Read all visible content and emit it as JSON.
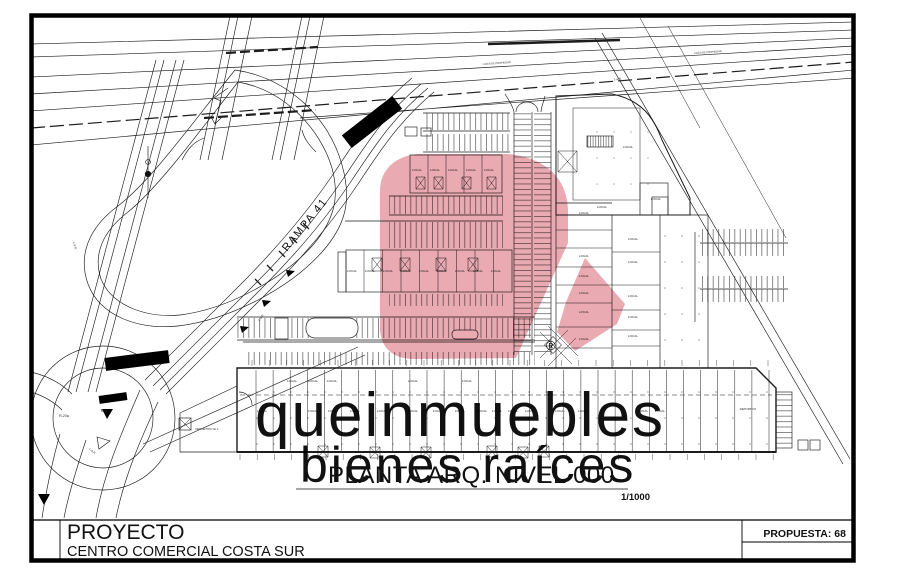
{
  "title_block": {
    "project_label": "PROYECTO",
    "project_name": "CENTRO COMERCIAL COSTA SUR",
    "proposal": "PROPUESTA: 68"
  },
  "plan": {
    "title": "PLANTA ARQ. NIVEL 000",
    "scale": "1/1000",
    "ramp_label": "RAMPA 41",
    "unit_label_default": "LOCAL",
    "unit_labels": [
      {
        "x": 417,
        "y": 171
      },
      {
        "x": 435,
        "y": 171
      },
      {
        "x": 453,
        "y": 171
      },
      {
        "x": 471,
        "y": 171
      },
      {
        "x": 489,
        "y": 171
      },
      {
        "x": 352,
        "y": 272
      },
      {
        "x": 370,
        "y": 272
      },
      {
        "x": 388,
        "y": 272
      },
      {
        "x": 406,
        "y": 272
      },
      {
        "x": 424,
        "y": 272
      },
      {
        "x": 442,
        "y": 272
      },
      {
        "x": 460,
        "y": 272
      },
      {
        "x": 478,
        "y": 272
      },
      {
        "x": 496,
        "y": 272
      },
      {
        "x": 584,
        "y": 214
      },
      {
        "x": 584,
        "y": 257
      },
      {
        "x": 584,
        "y": 277
      },
      {
        "x": 584,
        "y": 294
      },
      {
        "x": 584,
        "y": 313
      },
      {
        "x": 584,
        "y": 340
      },
      {
        "x": 633,
        "y": 240
      },
      {
        "x": 633,
        "y": 263
      },
      {
        "x": 633,
        "y": 297
      },
      {
        "x": 633,
        "y": 318
      },
      {
        "x": 633,
        "y": 337
      },
      {
        "x": 628,
        "y": 148
      },
      {
        "x": 602,
        "y": 208
      },
      {
        "x": 656,
        "y": 200
      },
      {
        "x": 292,
        "y": 382
      },
      {
        "x": 313,
        "y": 382
      },
      {
        "x": 332,
        "y": 382
      },
      {
        "x": 413,
        "y": 382
      },
      {
        "x": 467,
        "y": 382
      },
      {
        "x": 262,
        "y": 412
      },
      {
        "x": 313,
        "y": 412
      },
      {
        "x": 333,
        "y": 412
      },
      {
        "x": 355,
        "y": 412
      },
      {
        "x": 382,
        "y": 412
      },
      {
        "x": 413,
        "y": 412
      },
      {
        "x": 438,
        "y": 412
      },
      {
        "x": 460,
        "y": 412
      },
      {
        "x": 482,
        "y": 412
      },
      {
        "x": 497,
        "y": 412
      },
      {
        "x": 513,
        "y": 412
      },
      {
        "x": 530,
        "y": 412
      },
      {
        "x": 560,
        "y": 412
      },
      {
        "x": 583,
        "y": 412
      },
      {
        "x": 643,
        "y": 412
      },
      {
        "x": 660,
        "y": 412
      },
      {
        "x": 207,
        "y": 430,
        "t": "DEPORTIVO No.1",
        "s": 2.8
      },
      {
        "x": 748,
        "y": 410,
        "t": "DEPORTIVO",
        "s": 2.8
      }
    ],
    "road_labels": [
      {
        "t": "LINEA DE PROPIEDAD",
        "x": 497,
        "y": 64,
        "r": -4,
        "s": 2.6
      },
      {
        "t": "LINEA DE PROPIEDAD",
        "x": 708,
        "y": 53,
        "r": -4,
        "s": 2.6
      },
      {
        "t": "L.a.R.",
        "x": 618,
        "y": 80,
        "r": -4,
        "s": 3
      },
      {
        "t": "L.a.R.",
        "x": 262,
        "y": 318,
        "r": -50,
        "s": 3
      },
      {
        "t": "L.a.R.",
        "x": 74,
        "y": 246,
        "r": 75,
        "s": 3
      },
      {
        "t": "L.a.R.",
        "x": 92,
        "y": 452,
        "r": 40,
        "s": 3
      },
      {
        "t": "R-2",
        "x": 104,
        "y": 412,
        "s": 4.2
      },
      {
        "t": "R-20a",
        "x": 64,
        "y": 417,
        "s": 3.6
      }
    ]
  },
  "watermark": {
    "brand": "queinmuebles",
    "tagline": "bienes raíces",
    "registered": "®",
    "brand_color": "#c9c9c9",
    "tagline_color": "#dadada",
    "logo_color": "#e9aab2",
    "registered_color": "#c4424e"
  }
}
